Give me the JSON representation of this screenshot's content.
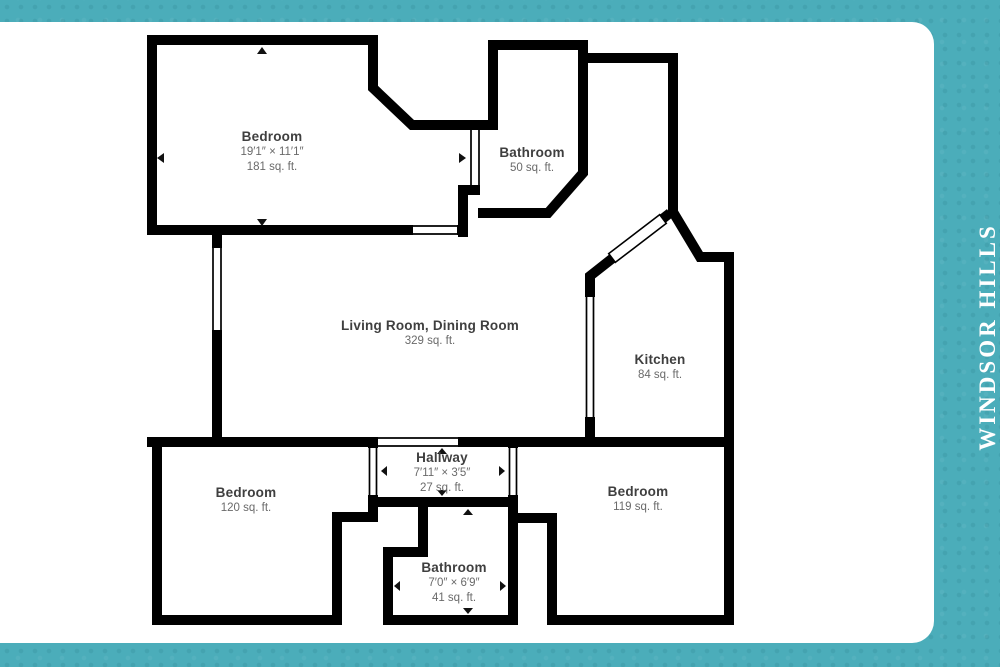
{
  "branding": {
    "community_name": "WINDSOR HILLS"
  },
  "floorplan": {
    "rooms": [
      {
        "id": "bedroom-1",
        "name": "Bedroom",
        "dimensions": "19′1″ × 11′1″",
        "area": "181 sq. ft."
      },
      {
        "id": "bathroom-1",
        "name": "Bathroom",
        "dimensions": "",
        "area": "50 sq. ft."
      },
      {
        "id": "living",
        "name": "Living Room, Dining Room",
        "dimensions": "",
        "area": "329 sq. ft."
      },
      {
        "id": "kitchen",
        "name": "Kitchen",
        "dimensions": "",
        "area": "84 sq. ft."
      },
      {
        "id": "hallway",
        "name": "Hallway",
        "dimensions": "7′11″ × 3′5″",
        "area": "27 sq. ft."
      },
      {
        "id": "bedroom-2",
        "name": "Bedroom",
        "dimensions": "",
        "area": "120 sq. ft."
      },
      {
        "id": "bedroom-3",
        "name": "Bedroom",
        "dimensions": "",
        "area": "119 sq. ft."
      },
      {
        "id": "bathroom-2",
        "name": "Bathroom",
        "dimensions": "7′0″ × 6′9″",
        "area": "41 sq. ft."
      }
    ],
    "colors": {
      "wall": "#000000",
      "room_name_text": "#3f3f3f",
      "room_detail_text": "#6a6a6a",
      "canvas": "#ffffff",
      "frame_teal": "#4badba",
      "community_text": "#ffffff"
    }
  }
}
